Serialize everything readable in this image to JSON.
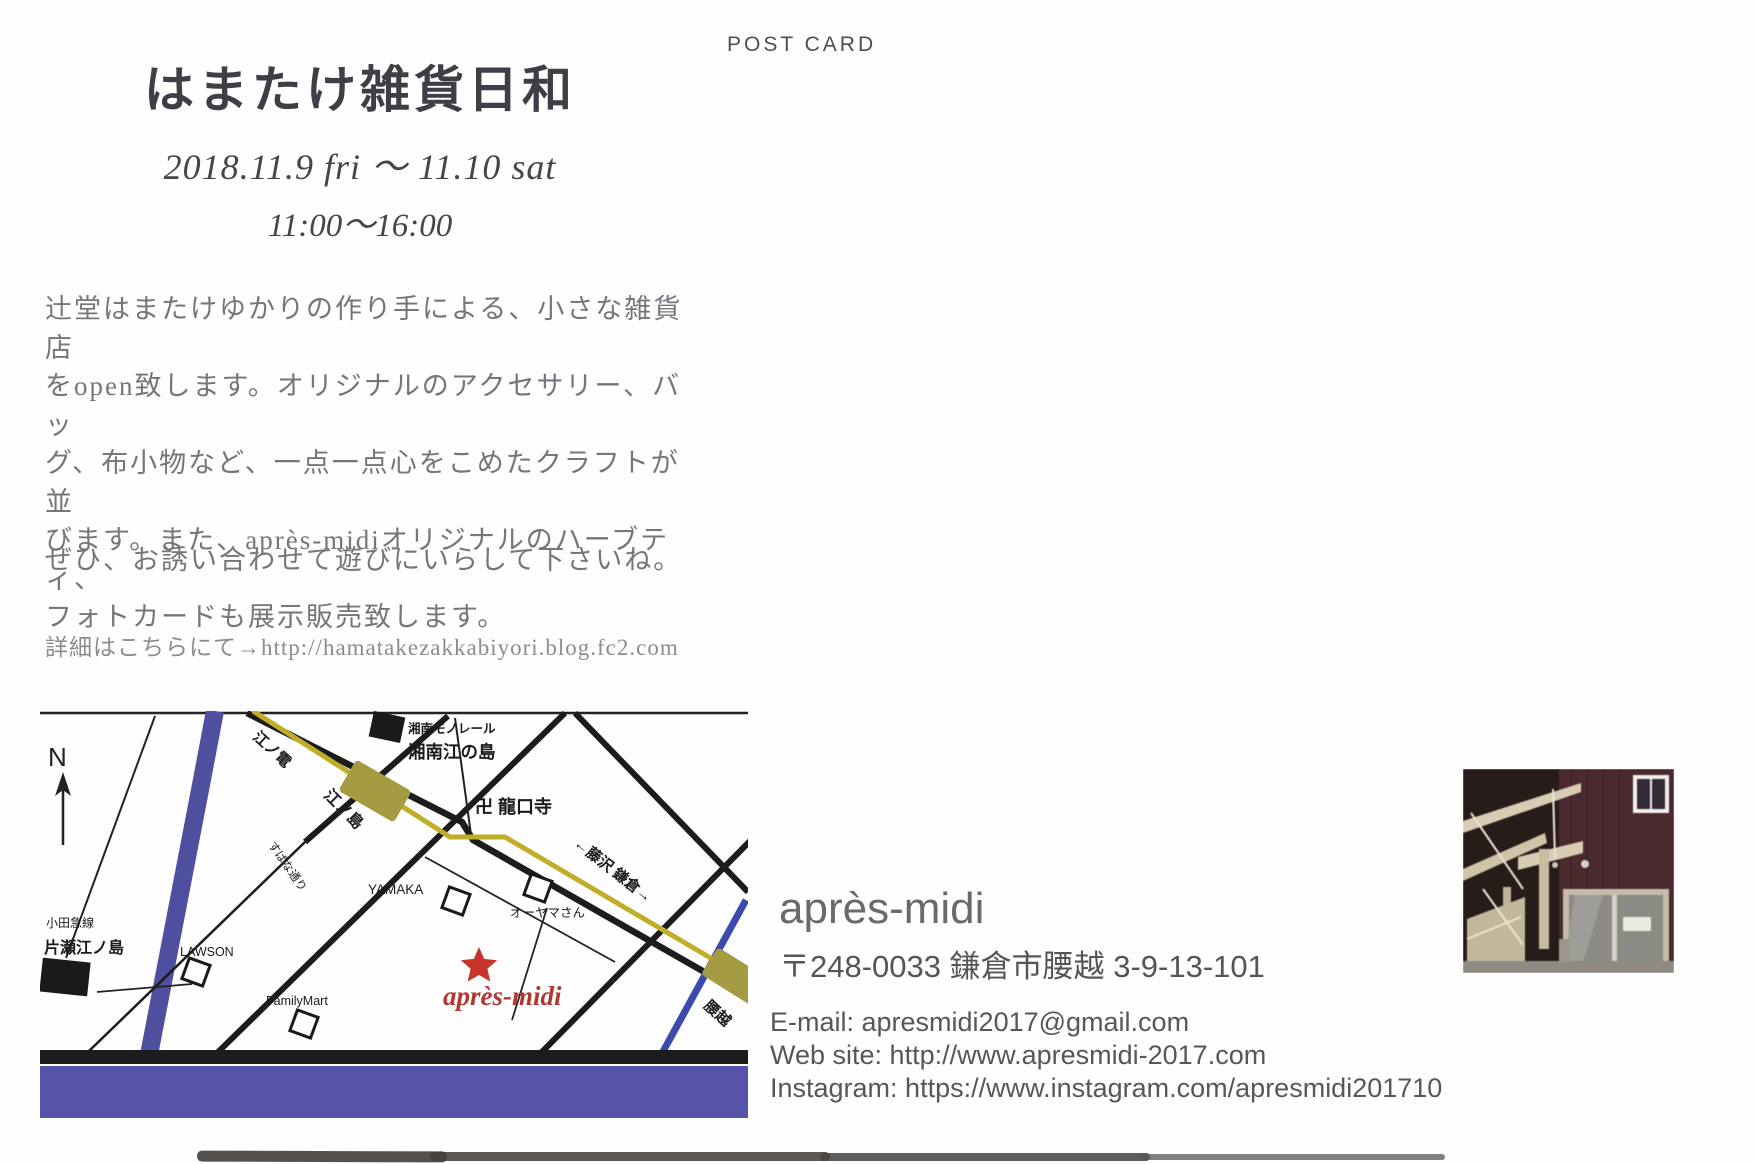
{
  "postcard": {
    "type_label": "POST CARD"
  },
  "event": {
    "title": "はまたけ雑貨日和",
    "date_line": "2018.11.9 fri 〜 11.10 sat",
    "time_line": "11:00〜16:00",
    "description_lines": [
      "辻堂はまたけゆかりの作り手による、小さな雑貨店",
      "をopen致します。オリジナルのアクセサリー、バッ",
      "グ、布小物など、一点一点心をこめたクラフトが並",
      "びます。また、après-midiオリジナルのハーブティ、",
      "フォトカードも展示販売致します。"
    ],
    "invitation_line": "ぜひ、お誘い合わせて遊びにいらして下さいね。",
    "details_line": "詳細はこちらにて→http://hamatakezakkabiyori.blog.fc2.com"
  },
  "map": {
    "compass_label": "N",
    "monorail_line_label": "湘南モノレール",
    "monorail_station_label": "湘南江の島",
    "enoden_line_label": "江ノ電",
    "enoshima_station_label": "江ノ島",
    "temple_label": "卍 龍口寺",
    "direction_label": "←藤沢 鎌倉→",
    "yamaka_label": "YAMAKA",
    "oyama_label": "オーヤマさん",
    "lawson_label": "LAWSON",
    "familymart_label": "FamilyMart",
    "subana_street_label": "すばな通り",
    "odakyu_line_label": "小田急線",
    "katase_station_label": "片瀬江ノ島",
    "koshigoe_station_label": "腰越",
    "shop_label": "après-midi"
  },
  "shop": {
    "name": "après-midi",
    "address": "〒248-0033 鎌倉市腰越 3-9-13-101",
    "email": "E-mail: apresmidi2017@gmail.com",
    "website": "Web site: http://www.apresmidi-2017.com",
    "instagram": "Instagram: https://www.instagram.com/apresmidi201710"
  },
  "colors": {
    "ink": "#3e3e46",
    "body_text": "#75757b",
    "map_road": "#1c1c1c",
    "enoden_yellow": "#c1ae28",
    "station_olive": "#a59b43",
    "river_purple": "#4f4fa0",
    "sea_purple": "#5753a8",
    "accent_red": "#c8332b",
    "shop_red": "#b23730",
    "contact_gray": "#575759"
  }
}
